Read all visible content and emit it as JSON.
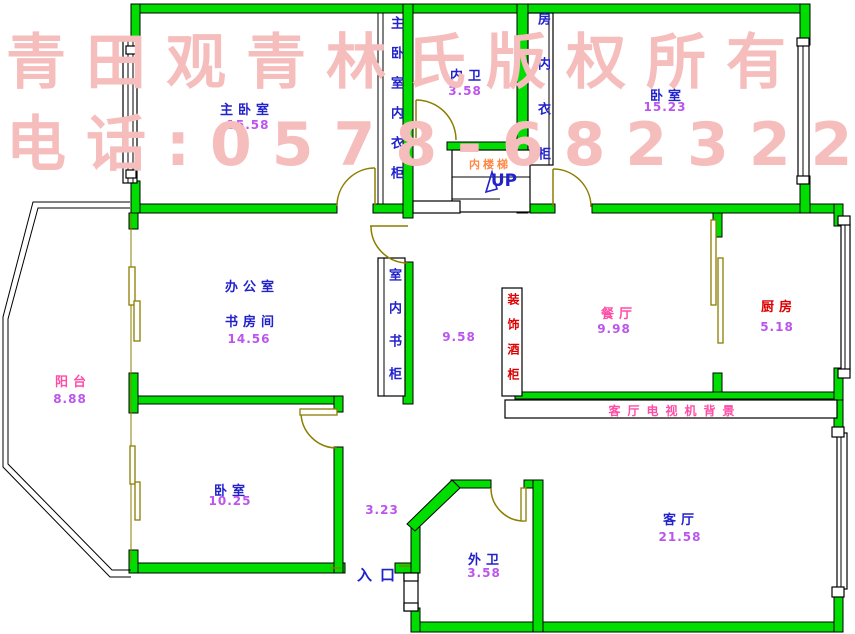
{
  "watermark": {
    "line1": "青田观青林氏版权所有",
    "line2": "电话:0578-68232287"
  },
  "rooms": {
    "master_bedroom": {
      "label": "主卧室",
      "area": "15.58"
    },
    "inner_bath": {
      "label": "内卫",
      "area": "3.58"
    },
    "bedroom_top_right": {
      "label": "卧室",
      "area": "15.23"
    },
    "office": {
      "line1": "办公室",
      "line2": "书房间",
      "area": "14.56"
    },
    "balcony": {
      "label": "阳台",
      "area": "8.88"
    },
    "corridor": {
      "area": "9.58"
    },
    "dining": {
      "label": "餐厅",
      "area": "9.98"
    },
    "kitchen": {
      "label": "厨房",
      "area": "5.18"
    },
    "bedroom_bottom_left": {
      "label": "卧室",
      "area": "10.25"
    },
    "entry_hall": {
      "area": "3.23"
    },
    "outer_bath": {
      "label": "外卫",
      "area": "3.58"
    },
    "living_room": {
      "label": "客厅",
      "area": "21.58"
    }
  },
  "fixtures": {
    "stairs_label": "内楼梯",
    "stairs_direction": "UP",
    "master_wardrobe": "主卧室内衣柜",
    "room_wardrobe": "房内衣柜",
    "bookcase": "室内书柜",
    "wine_cabinet": "装饰酒柜",
    "tv_wall": "客厅电视机背景",
    "entrance": "入口"
  },
  "colors": {
    "wall_fill": "#00dd00",
    "door_stroke": "#8c7e00",
    "room_label": "#2222cc",
    "area_value": "#bb55ee",
    "pink_label": "#ff4da6",
    "red_label": "#dd0000",
    "orange_label": "#ff8844",
    "watermark": "#f6bdbd"
  }
}
